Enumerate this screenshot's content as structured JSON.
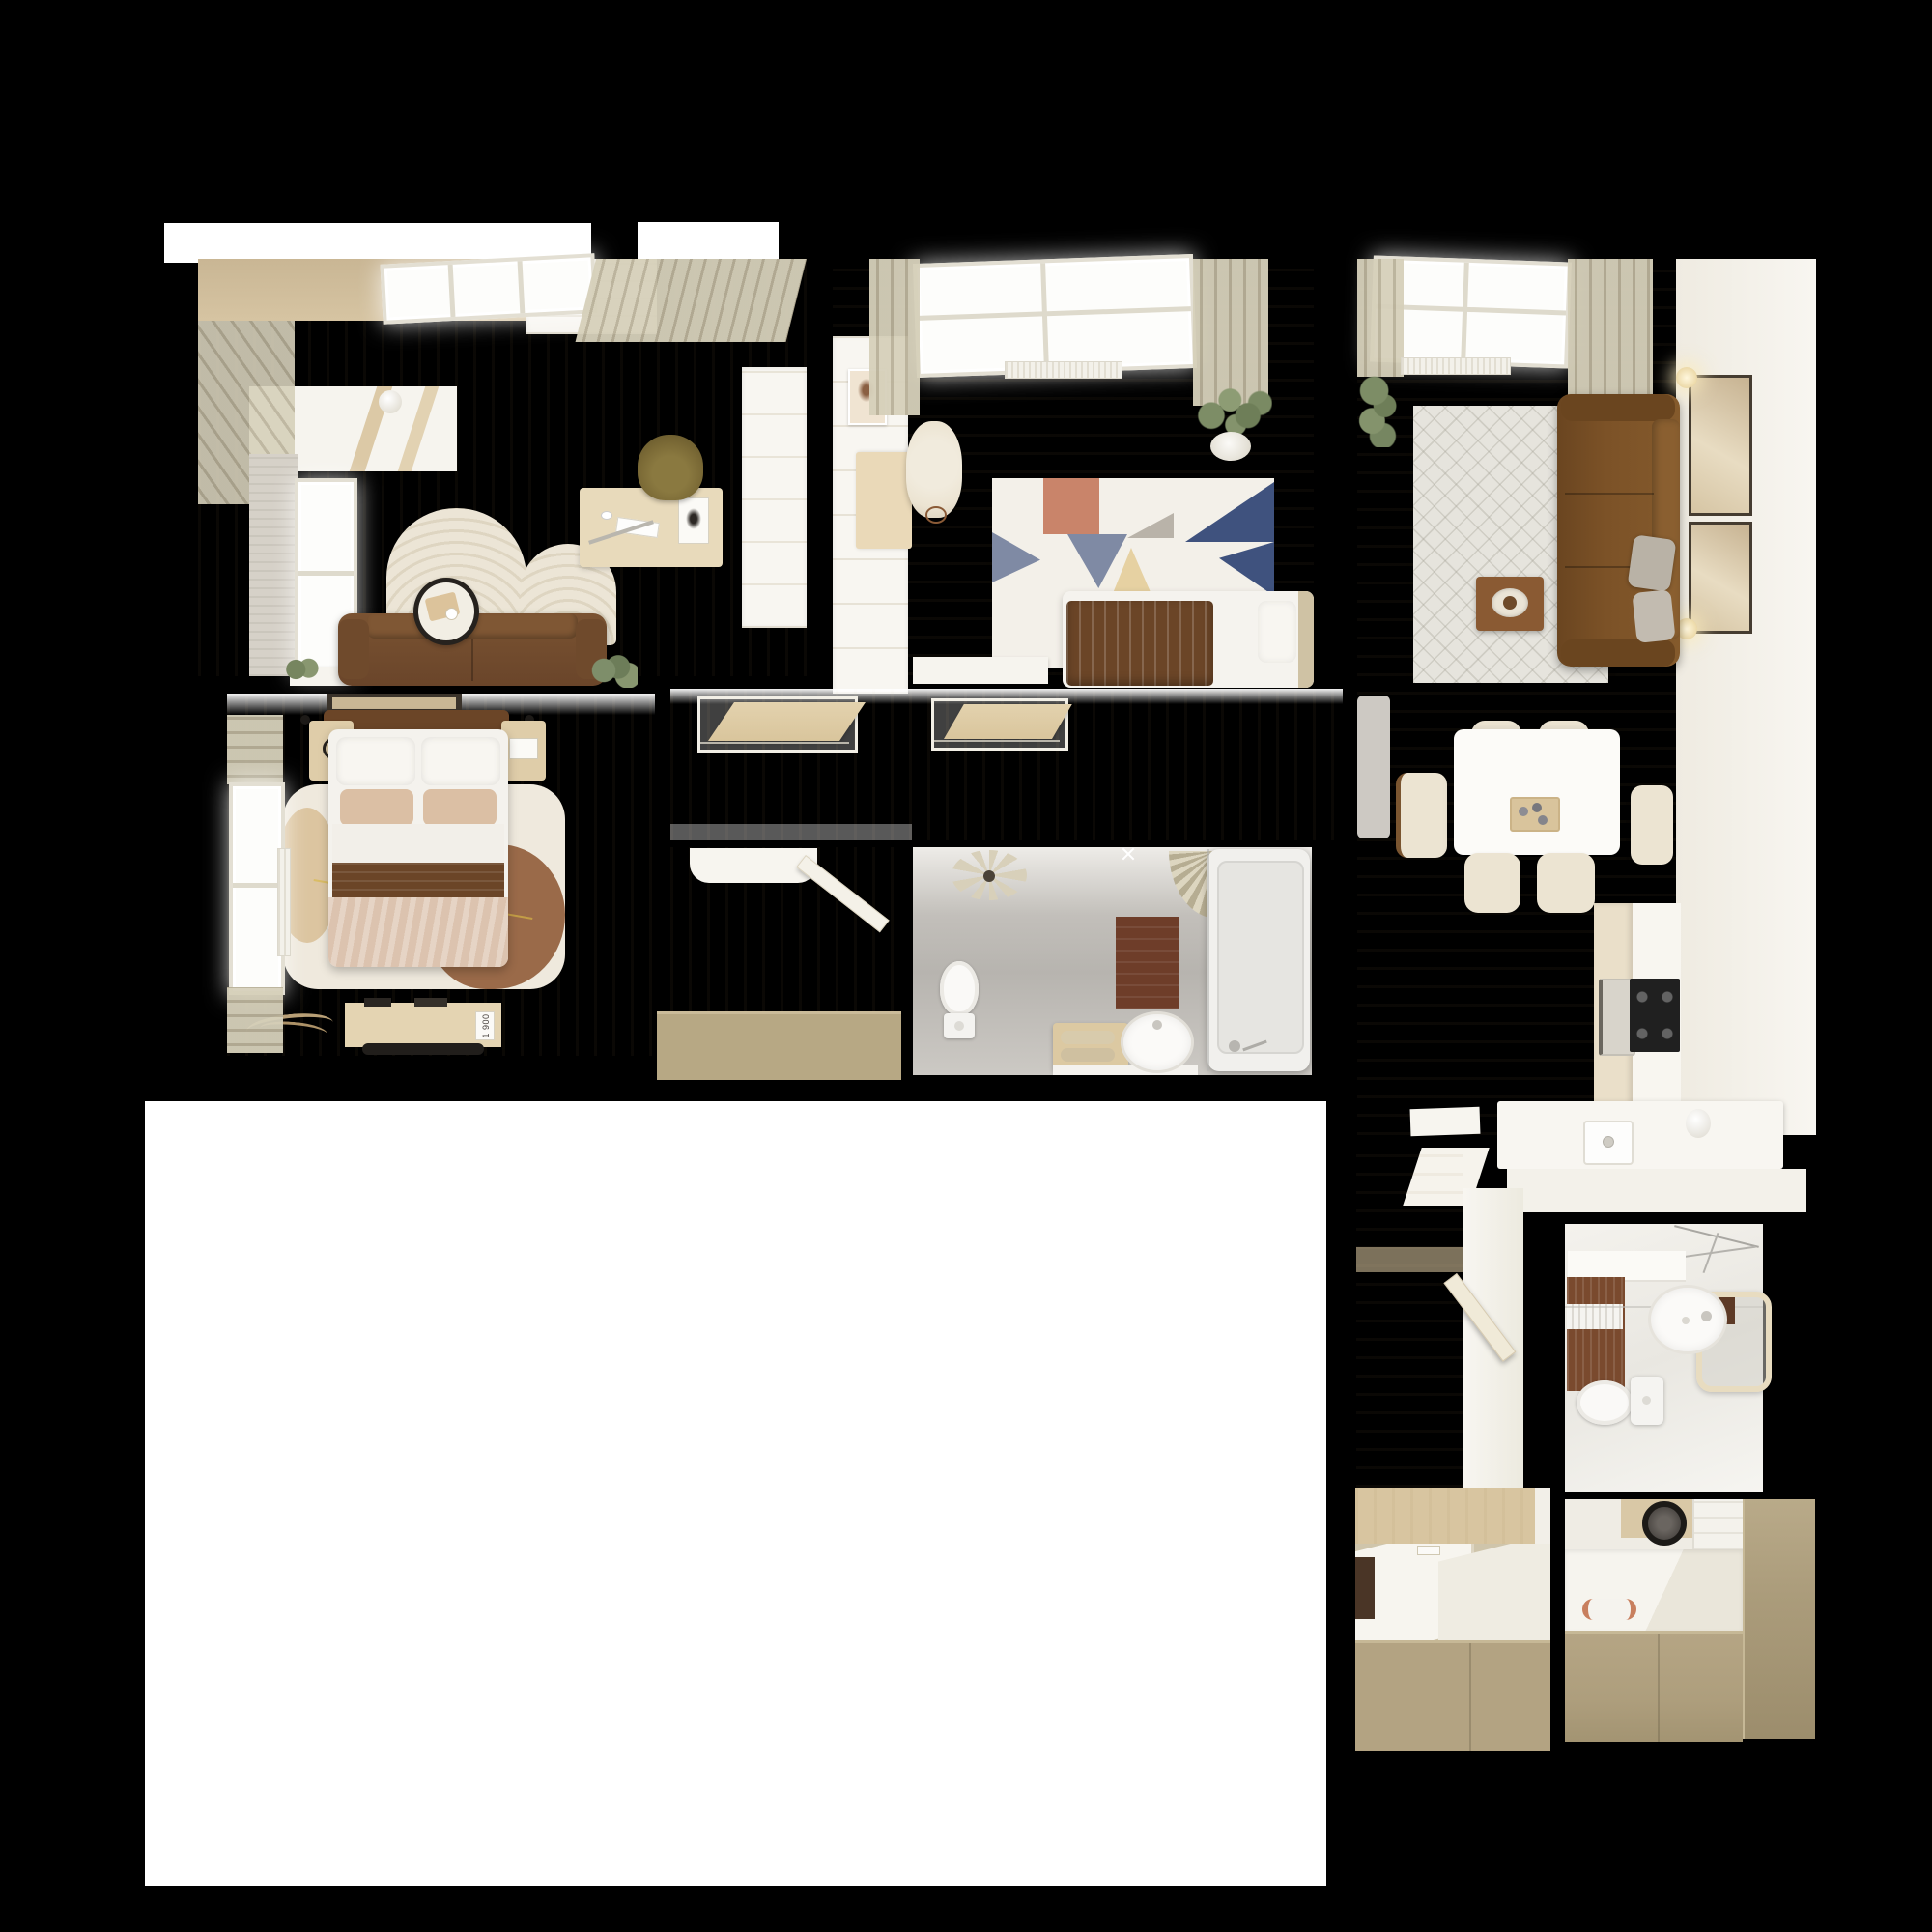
{
  "meta": {
    "description": "Top-down 3D render of a furnished apartment floor plan on a black background",
    "canvas": "2000x2000"
  },
  "palette": {
    "black": "#000000",
    "white": "#ffffff",
    "wall_white": "#f4f1ea",
    "floor_wood": "#ead9bd",
    "floor_dining": "#e2d1af",
    "curtain_light": "#d6d0ba",
    "curtain_dark": "#b9b199",
    "wood_cabinet": "#cdb492",
    "wood_furniture": "#e0d0ae",
    "office_sofa_brown": "#7a5332",
    "living_sofa_brown": "#7c5227",
    "bed_brown": "#6b4527",
    "duvet_pink": "#dcc3af",
    "pillow_beige": "#dbbfa4",
    "khaki": "#b3a382",
    "khaki_mat": "#b7a884",
    "rug_ivory": "#efe9dd",
    "rug_brown_blob": "#9a6a49",
    "kids_rug_white": "#f3f0e9",
    "terracotta": "#c9846a",
    "slate": "#7f8aa4",
    "navy": "#3f527e",
    "sand": "#e6d1a2",
    "gray_bath": "#b7b4af",
    "bath_mat_brown": "#6e3d29",
    "plant_green": "#7e8e6a",
    "cream_chair": "#ece4d2",
    "cooktop_black": "#202020",
    "runner_gray": "#cdc9c3"
  },
  "rooms": [
    {
      "id": "office-lounge",
      "label": "Office / Lounge"
    },
    {
      "id": "kids-bedroom",
      "label": "Kids Bedroom"
    },
    {
      "id": "living-dining-kitchen",
      "label": "Living / Dining / Kitchen"
    },
    {
      "id": "master-bedroom",
      "label": "Master Bedroom"
    },
    {
      "id": "hallway",
      "label": "Hallway"
    },
    {
      "id": "main-bathroom",
      "label": "Main Bathroom"
    },
    {
      "id": "entry-corridor",
      "label": "Entry Corridor"
    },
    {
      "id": "small-bathroom",
      "label": "Small Bathroom"
    },
    {
      "id": "laundry-storage",
      "label": "Laundry / Storage"
    },
    {
      "id": "entry-wardrobe",
      "label": "Entry Wardrobe"
    }
  ],
  "bedroom": {
    "bench_card_label": "1 900"
  }
}
